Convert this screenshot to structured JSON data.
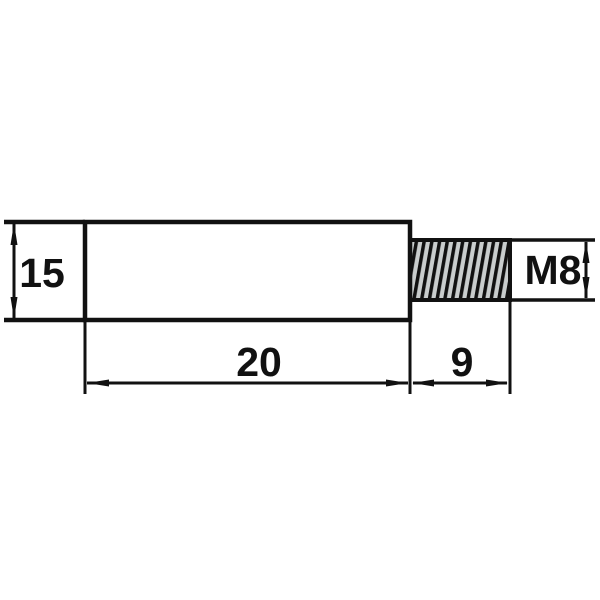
{
  "drawing": {
    "labels": {
      "body_height": "15",
      "body_length": "20",
      "thread_length": "9",
      "thread_size": "M8"
    },
    "colors": {
      "line": "#111111",
      "body_fill": "#b9bcbc",
      "thread_fill": "#c9cdcd",
      "background": "#ffffff"
    }
  }
}
